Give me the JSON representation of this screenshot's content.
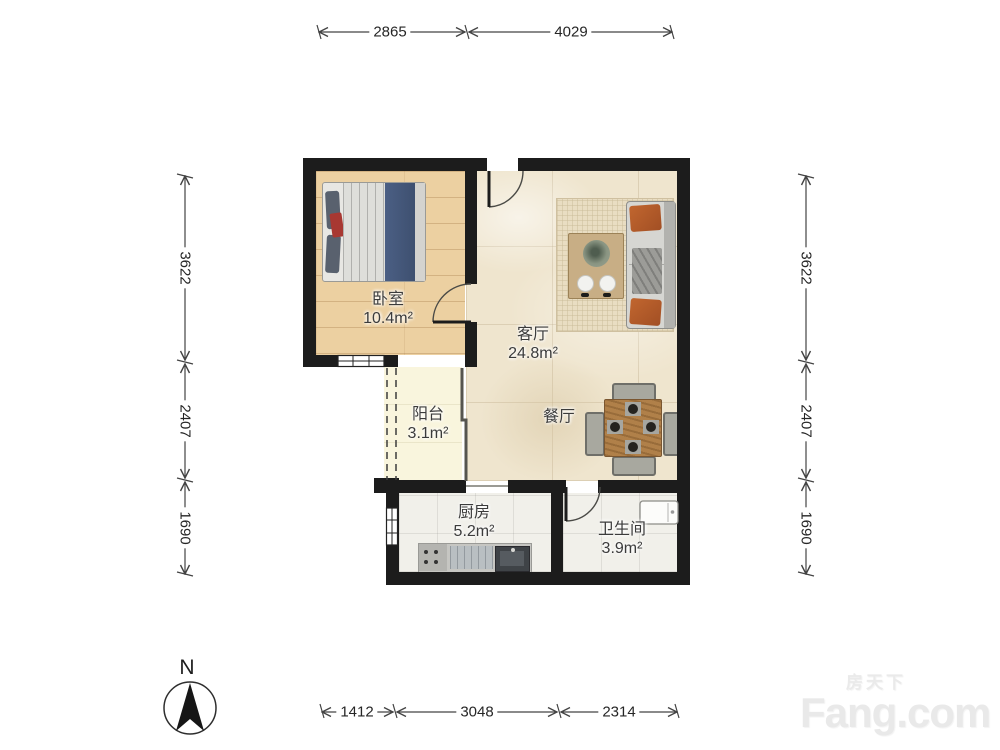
{
  "compass": {
    "label": "N"
  },
  "watermark": {
    "cn": "房天下",
    "en": "Fang.com"
  },
  "rooms": [
    {
      "id": "bedroom",
      "name": "卧室",
      "area": "10.4m²"
    },
    {
      "id": "living-room",
      "name": "客厅",
      "area": "24.8m²"
    },
    {
      "id": "dining-area",
      "name": "餐厅",
      "area": ""
    },
    {
      "id": "balcony",
      "name": "阳台",
      "area": "3.1m²"
    },
    {
      "id": "kitchen",
      "name": "厨房",
      "area": "5.2m²"
    },
    {
      "id": "bathroom",
      "name": "卫生间",
      "area": "3.9m²"
    }
  ],
  "dimensions_mm": {
    "top": [
      "2865",
      "4029"
    ],
    "bottom": [
      "1412",
      "3048",
      "2314"
    ],
    "left": [
      "3622",
      "2407",
      "1690"
    ],
    "right": [
      "3622",
      "2407",
      "1690"
    ]
  },
  "colors": {
    "wall": "#1c1c1c",
    "wood_floor": "#ecd0a1",
    "marble_floor": "#efe5ce",
    "balcony_floor": "#f9f5dd",
    "tile_floor": "#f1f0ea",
    "sofa_pillow_accent": "#b05a2a",
    "bed_blanket": "#44587c",
    "dimension_line": "#444444",
    "watermark_text": "#e9e9e9"
  }
}
